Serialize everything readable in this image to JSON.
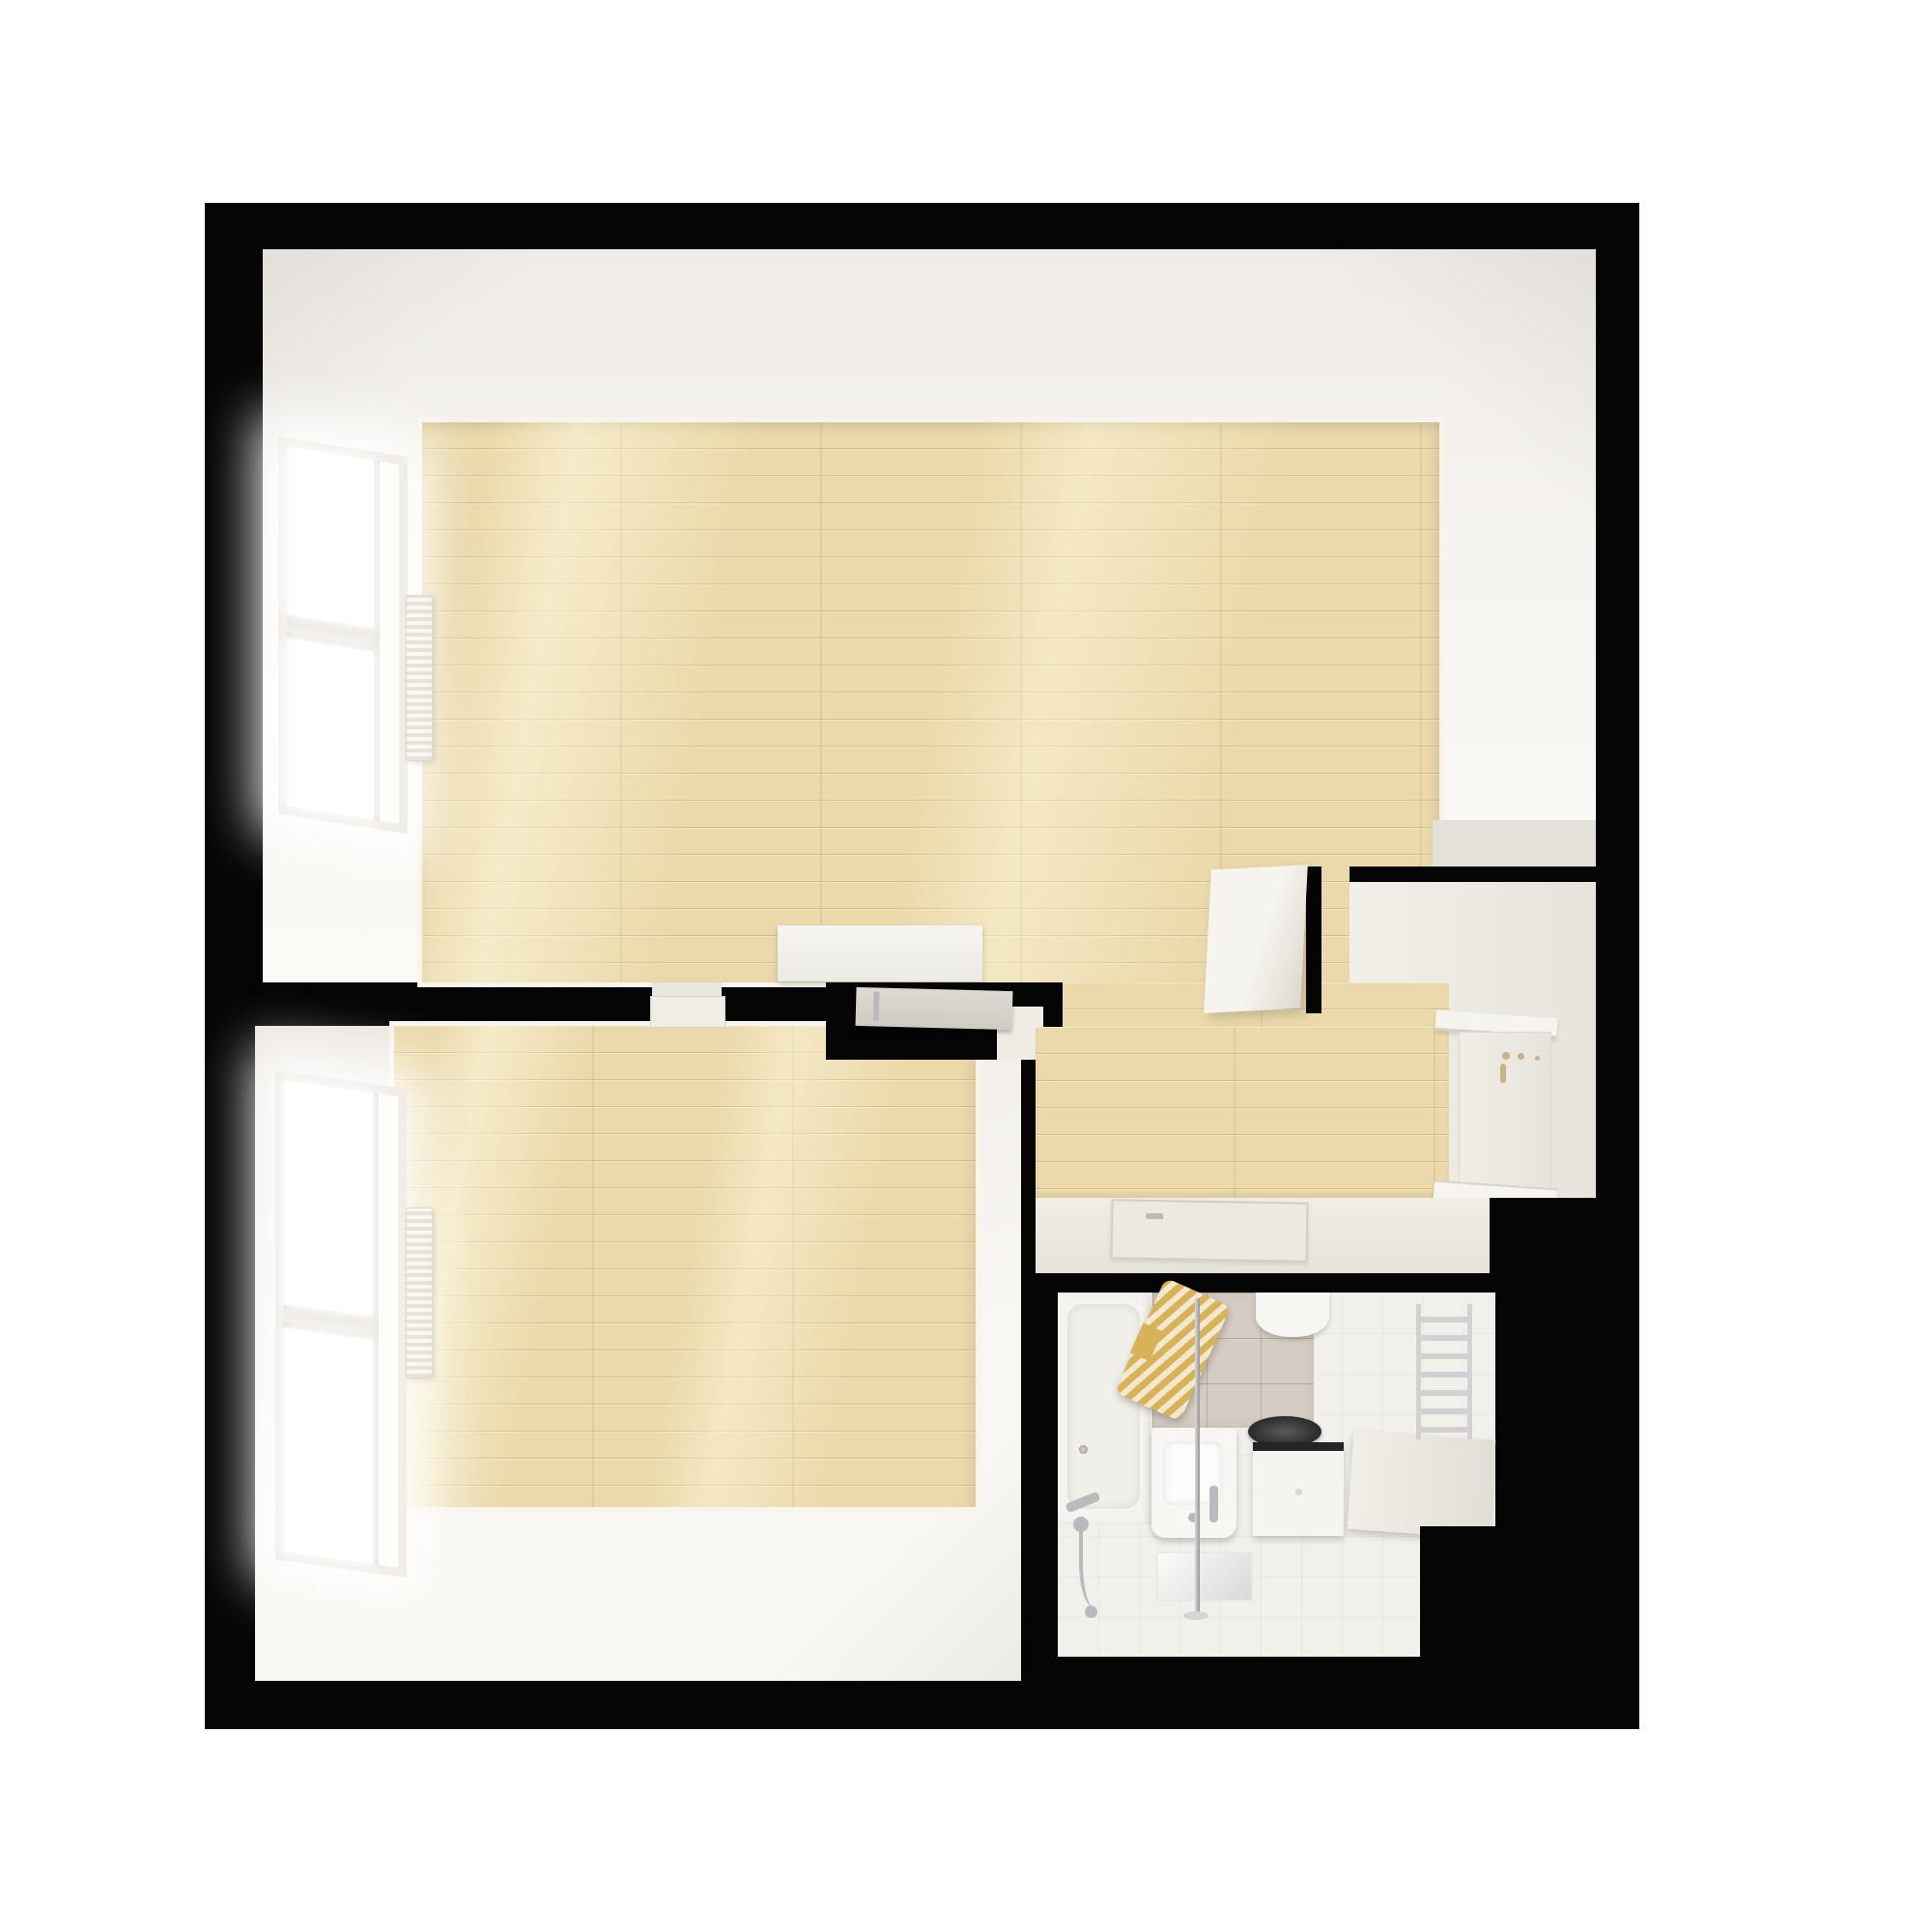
{
  "meta": {
    "title": "apartment-floor-plan-3d-top-view",
    "view": "top-down 3d render",
    "visible_text": "none"
  },
  "palette": {
    "page_bg": "#ffffff",
    "wall_black": "#050505",
    "wall_white": "#f6f4f0",
    "wall_dim": "#e7e3dc",
    "ceil": "#efece7",
    "wood": "#ebd9ab",
    "wood_line": "#cdb37c",
    "board": "#f7f4ee",
    "tile_wall": "#d5cdc3",
    "bath_floor": "#f2f0eb",
    "fix_white": "#f8f6f2",
    "chrome": "#b9babd",
    "gold": "#d7b258",
    "gold_light": "#f2e8cb",
    "sink_dark": "#3a3a3a"
  },
  "rooms": [
    {
      "id": "living-room",
      "floor": "light-wood-planks",
      "features": [
        "left-wall-window",
        "wall-radiator",
        "white-sideboard",
        "open-white-door-near-kitchen"
      ]
    },
    {
      "id": "bedroom",
      "floor": "light-wood-planks",
      "features": [
        "left-wall-window",
        "wall-radiator",
        "doorway-with-open-leaf",
        "grey-open-door-leaf"
      ]
    },
    {
      "id": "hallway",
      "floor": "light-wood-planks",
      "features": [
        "open-passage-from-living-room"
      ]
    },
    {
      "id": "kitchen-niche",
      "floor": "white",
      "features": [
        "upper-shelf",
        "fold-down-counter-panel",
        "hardware-knobs",
        "lower-shelf"
      ]
    },
    {
      "id": "bathroom",
      "floor": "white-tile-grid",
      "features": [
        "bathtub",
        "tub-faucet-and-hand-shower",
        "shower-column-pole",
        "gold-striped-towel",
        "grey-wall-tiles",
        "wall-hung-toilet",
        "bidet",
        "round-dark-basin-on-cabinet",
        "side-counter",
        "ladder-towel-radiator",
        "open-flat-door-leaf",
        "floor-mirror-panel"
      ]
    }
  ]
}
